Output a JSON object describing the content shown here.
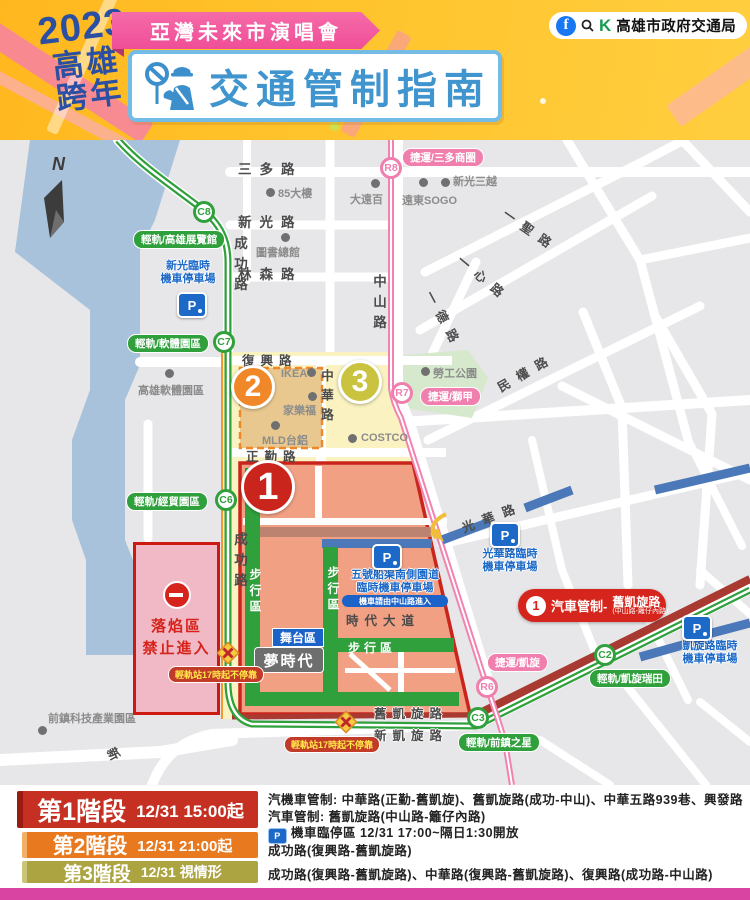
{
  "header": {
    "year": "2023",
    "city_top": "高雄",
    "city_bottom": "跨年",
    "event_banner": "亞灣未來市演唱會",
    "title": "交通管制指南",
    "bureau": "高雄市政府交通局",
    "logo_letter": "K",
    "fb_letter": "f"
  },
  "map": {
    "compass_n": "N",
    "roads": {
      "sanduo": "三多路",
      "xinguang": "新光路",
      "linsen": "林森路",
      "chenggong": "成功路",
      "zhongshan": "中山路",
      "zhonghua": "中華路",
      "fuxing": "復興路",
      "zhengqin": "正勤路",
      "yisheng": "一聖路",
      "yixin": "一心路",
      "yide": "一德路",
      "minquan": "民權路",
      "guanghua": "光華路",
      "shidai": "時代大道",
      "jiu_kaixuan": "舊凱旋路",
      "xin_kaixuan": "新凱旋路",
      "xin_partial": "新"
    },
    "landmarks": {
      "tower85": "85大樓",
      "dayuanbai": "大遠百",
      "sogo": "遠東SOGO",
      "shinkong": "新光三越",
      "library": "圖書總館",
      "software_park": "高雄軟體園區",
      "labor_park": "勞工公園",
      "costco": "COSTCO",
      "ikea": "IKEA",
      "carrefour": "家樂福",
      "mld": "MLD台鋁",
      "qianzhen_park": "前鎮科技產業園區",
      "dream_mall": "夢時代"
    },
    "stations": {
      "c8": {
        "id": "C8",
        "label": "輕軌/高雄展覽館"
      },
      "c7": {
        "id": "C7",
        "label": "輕軌/軟體園區"
      },
      "c6": {
        "id": "C6",
        "label": "輕軌/經貿園區"
      },
      "c3": {
        "id": "C3",
        "label": "輕軌/前鎮之星"
      },
      "c2": {
        "id": "C2",
        "label": "輕軌/凱旋瑞田"
      },
      "r8": {
        "id": "R8",
        "label": "捷運/三多商圈"
      },
      "r7": {
        "id": "R7",
        "label": "捷運/獅甲"
      },
      "r6": {
        "id": "R6",
        "label": "捷運/凱旋"
      }
    },
    "parkings": {
      "xinguang": {
        "line1": "新光臨時",
        "line2": "機車停車場"
      },
      "guanghua": {
        "line1": "光華路臨時",
        "line2": "機車停車場"
      },
      "kaixuan": {
        "line1": "凱旋路臨時",
        "line2": "機車停車場"
      },
      "wuhao": {
        "line1": "五號船渠南側園道",
        "line2": "臨時機車停車場",
        "note": "機車請由中山路進入"
      }
    },
    "zones": {
      "z1": "1",
      "z2": "2",
      "z3": "3"
    },
    "stage_area": "舞台區",
    "walk_zone": "步行區",
    "no_entry": {
      "line1": "落焰區",
      "line2": "禁止進入"
    },
    "lrt_no_stop": "輕軌站17時起不停靠",
    "car_control_badge": {
      "num": "1",
      "label": "汽車管制-",
      "road": "舊凱旋路",
      "sub": "(中山路-籬仔內路)"
    }
  },
  "legend": {
    "phase1": {
      "name": "第1階段",
      "time": "12/31 15:00起",
      "line1": "汽機車管制: 中華路(正勤-舊凱旋)、舊凱旋路(成功-中山)、中華五路939巷、興發路",
      "line2": "汽車管制: 舊凱旋路(中山路-籬仔內路)",
      "line3": "機車臨停區 12/31  17:00~隔日1:30開放",
      "p_letter": "P"
    },
    "phase2": {
      "name": "第2階段",
      "time": "12/31 21:00起",
      "line1": "成功路(復興路-舊凱旋路)"
    },
    "phase3": {
      "name": "第3階段",
      "time": "12/31 視情形",
      "line1": "成功路(復興路-舊凱旋路)、中華路(復興路-舊凱旋路)、復興路(成功路-中山路)"
    }
  },
  "colors": {
    "lrt_green": "#2FA03C",
    "mrt_pink": "#F282B0",
    "zone1_red": "#C9251C",
    "phase1_red": "#C53022",
    "phase2_orange": "#E8791F",
    "phase3_olive": "#ABA441",
    "parking_blue": "#1D69C8",
    "accent_magenta": "#D943A1"
  }
}
